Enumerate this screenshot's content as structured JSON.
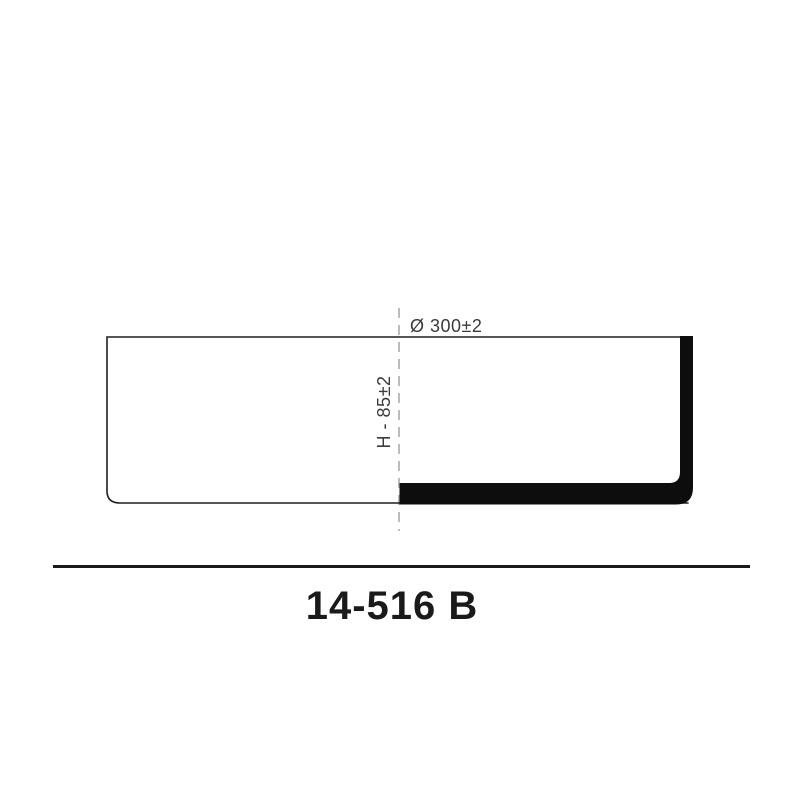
{
  "drawing": {
    "diameter_label": "Ø 300±2",
    "height_label": "H - 85±2",
    "ink_color": "#1f1f1f",
    "section_fill_color": "#0d0d0d",
    "centerline_color": "#b5b5b5",
    "dimension_text_color": "#3a3a3a"
  },
  "title": {
    "text": "14-516 B",
    "color": "#1a1a1a"
  }
}
